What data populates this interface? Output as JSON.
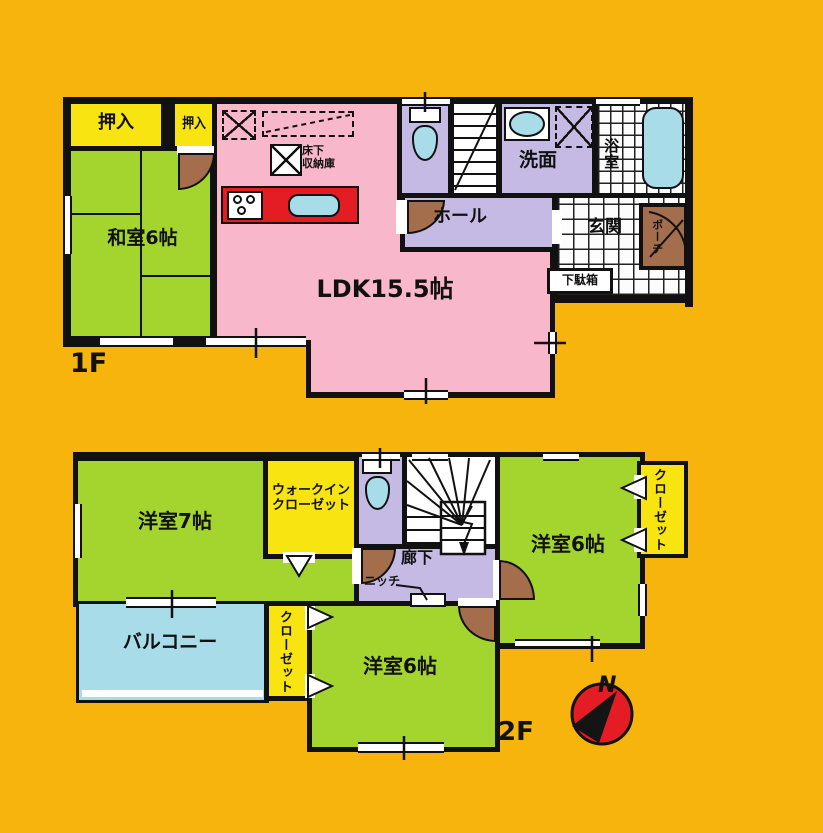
{
  "title": "2-story house floor plan",
  "floor1": {
    "label": "1F",
    "rooms": {
      "oshiire1": "押入",
      "oshiire2": "押入",
      "washitsu": "和室6帖",
      "ldk": "LDK15.5帖",
      "underfloor_storage": "床下\n収納庫",
      "hall": "ホール",
      "washroom": "洗面",
      "bathroom": "浴室",
      "entrance": "玄関",
      "shoe_cabinet": "下駄箱",
      "porch": "ポーチ"
    }
  },
  "floor2": {
    "label": "2F",
    "rooms": {
      "western7": "洋室7帖",
      "walk_in_closet": "ウォークイン\nクローゼット",
      "western6_right": "洋室6帖",
      "closet_right": "クローゼット",
      "corridor": "廊下",
      "niche": "ニッチ",
      "balcony": "バルコニー",
      "closet_bottom": "クローゼット",
      "western6_bottom": "洋室6帖"
    }
  },
  "compass": {
    "north_label": "N"
  },
  "colors": {
    "background": "#F6B40D",
    "ldk_pink": "#F8B7CA",
    "room_green": "#A4D52F",
    "closet_yellow": "#F8E411",
    "hall_purple": "#C5BAE3",
    "water_blue": "#A9DCE9",
    "counter_red": "#E41D25",
    "door_brown": "#A46D4B",
    "wall_black": "#111111"
  }
}
